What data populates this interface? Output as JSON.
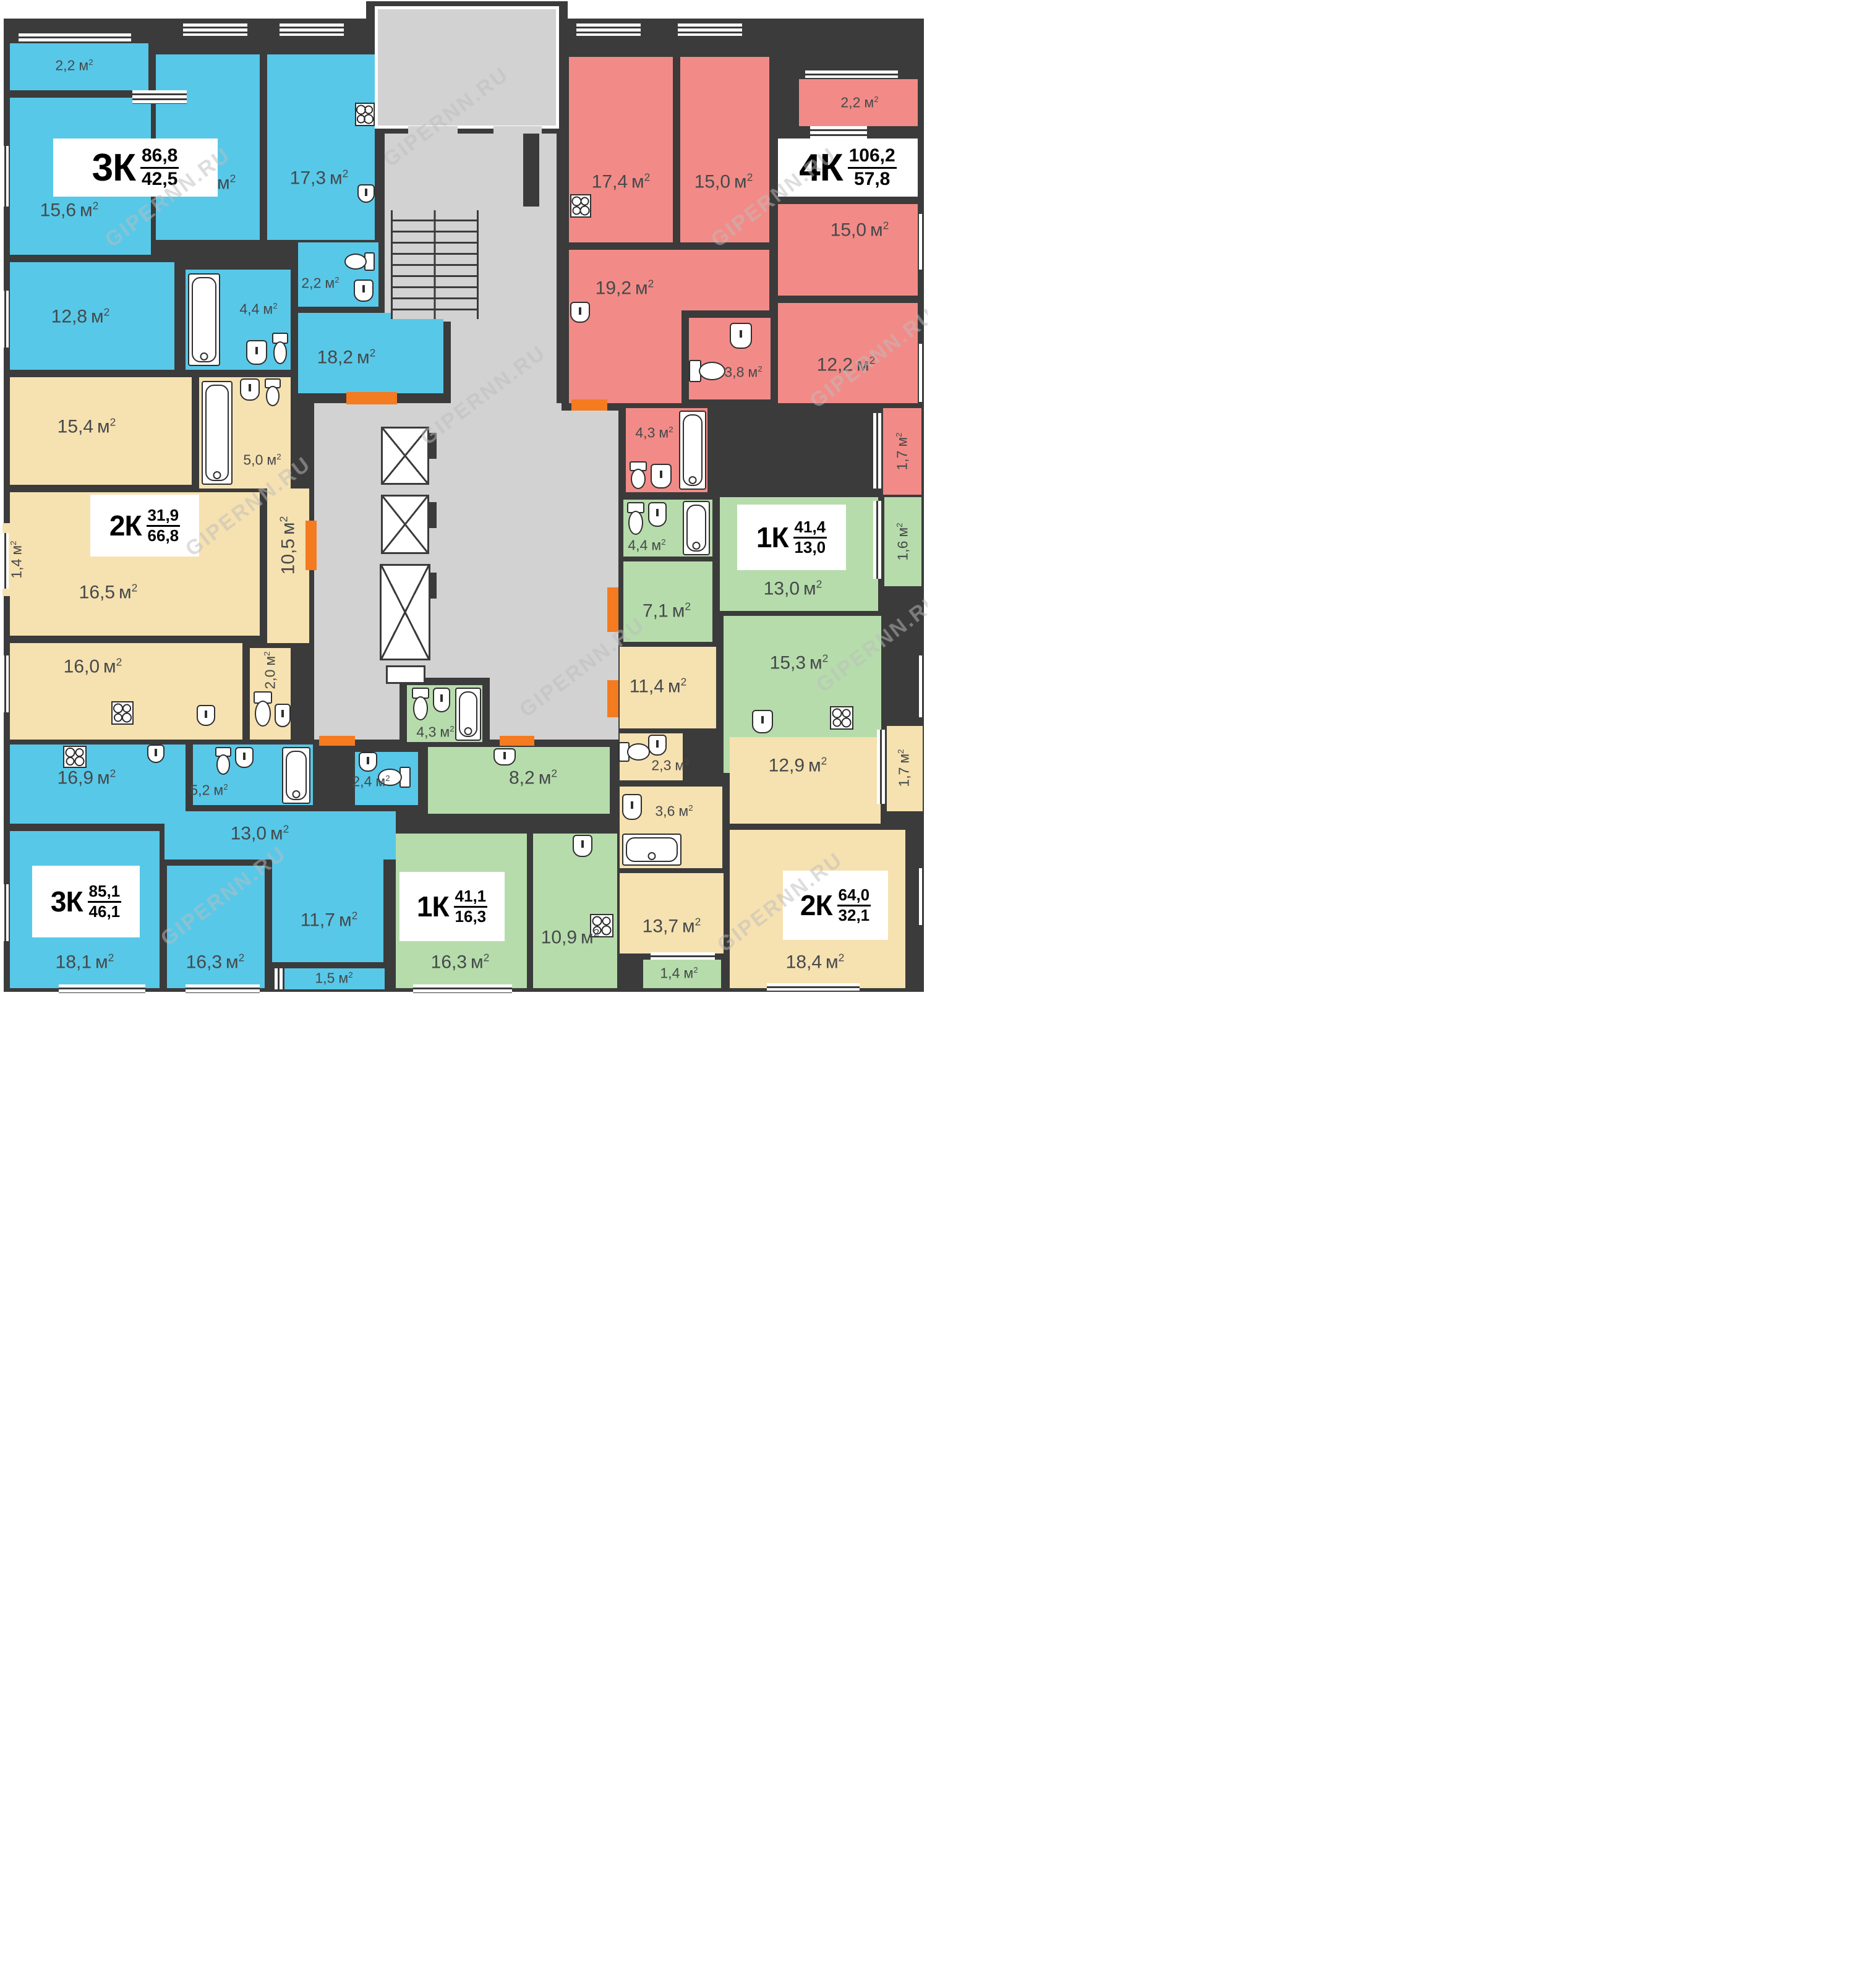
{
  "watermark": "GIPERNN.RU",
  "units": {
    "m": "м",
    "sup": "2"
  },
  "colors": {
    "wall": "#3b3b3b",
    "common_area": "#d2d2d2",
    "apartment_blue": "#58c8e8",
    "apartment_red": "#f28b87",
    "apartment_tan": "#f6e1b0",
    "apartment_green": "#b6dcab",
    "door_threshold": "#f47b20"
  },
  "apartments": [
    {
      "id": "3k-top-left",
      "type": "3К",
      "value_top": "86,8",
      "value_bottom": "42,5",
      "color": "blue",
      "rooms": [
        {
          "name": "balcony",
          "area": "2,2"
        },
        {
          "name": "room",
          "area": "15,6"
        },
        {
          "name": "room",
          "area": "14,1"
        },
        {
          "name": "kitchen-living",
          "area": "17,3"
        },
        {
          "name": "room",
          "area": "12,8"
        },
        {
          "name": "bathroom",
          "area": "4,4"
        },
        {
          "name": "wc",
          "area": "2,2"
        },
        {
          "name": "hall",
          "area": "18,2"
        }
      ]
    },
    {
      "id": "2k-mid-left",
      "type": "2К",
      "value_top": "31,9",
      "value_bottom": "66,8",
      "color": "tan",
      "rooms": [
        {
          "name": "room",
          "area": "15,4"
        },
        {
          "name": "bathroom",
          "area": "5,0"
        },
        {
          "name": "balcony",
          "area": "1,4"
        },
        {
          "name": "room",
          "area": "16,5"
        },
        {
          "name": "corridor",
          "area": "10,5"
        },
        {
          "name": "kitchen",
          "area": "16,0"
        },
        {
          "name": "wc",
          "area": "2,0"
        }
      ]
    },
    {
      "id": "3k-bottom-left",
      "type": "3К",
      "value_top": "85,1",
      "value_bottom": "46,1",
      "color": "blue",
      "rooms": [
        {
          "name": "kitchen-living",
          "area": "16,9"
        },
        {
          "name": "bathroom",
          "area": "5,2"
        },
        {
          "name": "wc",
          "area": "2,4"
        },
        {
          "name": "hall",
          "area": "13,0"
        },
        {
          "name": "room",
          "area": "18,1"
        },
        {
          "name": "room",
          "area": "16,3"
        },
        {
          "name": "room",
          "area": "11,7"
        },
        {
          "name": "balcony",
          "area": "1,5"
        }
      ]
    },
    {
      "id": "1k-bottom-middle",
      "type": "1К",
      "value_top": "41,1",
      "value_bottom": "16,3",
      "color": "green",
      "rooms": [
        {
          "name": "bathroom",
          "area": "4,3"
        },
        {
          "name": "hall",
          "area": "8,2"
        },
        {
          "name": "room",
          "area": "16,3"
        },
        {
          "name": "kitchen",
          "area": "10,9"
        },
        {
          "name": "balcony",
          "area": "1,4"
        }
      ]
    },
    {
      "id": "4k-top-right",
      "type": "4К",
      "value_top": "106,2",
      "value_bottom": "57,8",
      "color": "red",
      "rooms": [
        {
          "name": "kitchen-living",
          "area": "17,4"
        },
        {
          "name": "room",
          "area": "15,0"
        },
        {
          "name": "balcony",
          "area": "2,2"
        },
        {
          "name": "room",
          "area": "15,0"
        },
        {
          "name": "room",
          "area": "19,2"
        },
        {
          "name": "wc",
          "area": "3,8"
        },
        {
          "name": "room",
          "area": "12,2"
        },
        {
          "name": "bathroom",
          "area": "4,3"
        },
        {
          "name": "balcony",
          "area": "1,7"
        }
      ]
    },
    {
      "id": "1k-mid-right",
      "type": "1К",
      "value_top": "41,4",
      "value_bottom": "13,0",
      "color": "green",
      "rooms": [
        {
          "name": "bathroom",
          "area": "4,4"
        },
        {
          "name": "room",
          "area": "13,0"
        },
        {
          "name": "balcony",
          "area": "1,6"
        },
        {
          "name": "hall",
          "area": "7,1"
        },
        {
          "name": "kitchen-living",
          "area": "15,3"
        }
      ]
    },
    {
      "id": "2k-bottom-right",
      "type": "2К",
      "value_top": "64,0",
      "value_bottom": "32,1",
      "color": "tan",
      "rooms": [
        {
          "name": "hall",
          "area": "11,4"
        },
        {
          "name": "wc",
          "area": "2,3"
        },
        {
          "name": "bathroom",
          "area": "3,6"
        },
        {
          "name": "room",
          "area": "12,9"
        },
        {
          "name": "balcony",
          "area": "1,7"
        },
        {
          "name": "room",
          "area": "13,7"
        },
        {
          "name": "room",
          "area": "18,4"
        }
      ]
    }
  ]
}
